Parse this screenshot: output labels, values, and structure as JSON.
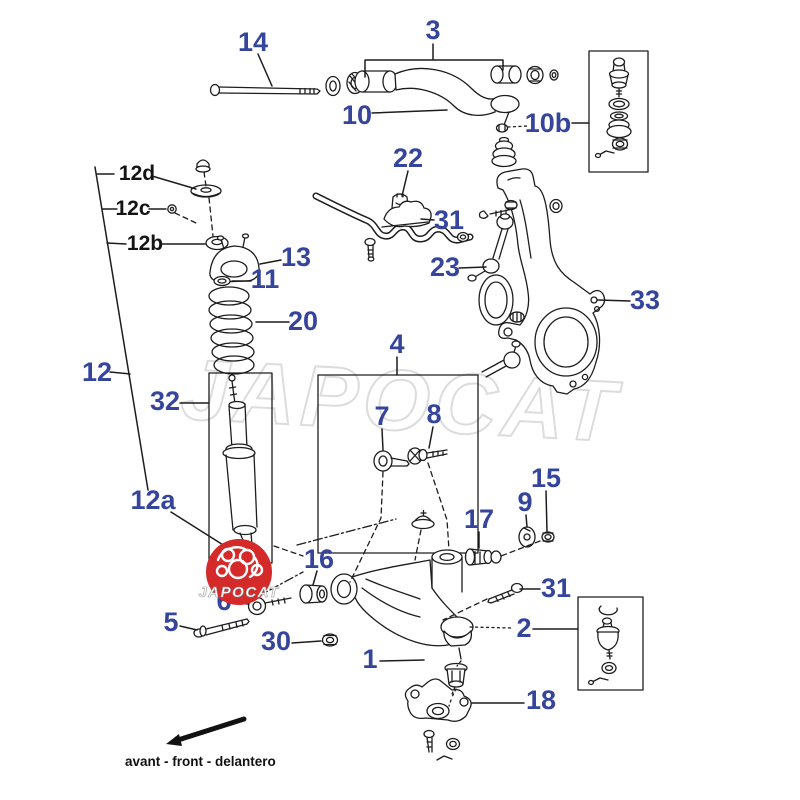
{
  "diagram": {
    "watermark_text": "JAPOCAT",
    "logo": {
      "text": "JAPOCAT",
      "bg_color": "#d42a2a"
    },
    "direction_label": "avant - front - delantero",
    "colors": {
      "label_blue": "#36459c",
      "label_black": "#141414",
      "line": "#1d1d1d",
      "logo_red": "#d42a2a",
      "watermark_gray": "#dcdcdc"
    },
    "labels": [
      {
        "id": "14",
        "text": "14"
      },
      {
        "id": "3",
        "text": "3"
      },
      {
        "id": "10",
        "text": "10"
      },
      {
        "id": "10b",
        "text": "10b"
      },
      {
        "id": "22",
        "text": "22"
      },
      {
        "id": "12d",
        "text": "12d"
      },
      {
        "id": "12c",
        "text": "12c"
      },
      {
        "id": "12b",
        "text": "12b"
      },
      {
        "id": "13",
        "text": "13"
      },
      {
        "id": "11",
        "text": "11"
      },
      {
        "id": "20",
        "text": "20"
      },
      {
        "id": "31-bracket",
        "text": "31"
      },
      {
        "id": "23",
        "text": "23"
      },
      {
        "id": "33",
        "text": "33"
      },
      {
        "id": "12",
        "text": "12"
      },
      {
        "id": "32",
        "text": "32"
      },
      {
        "id": "12a",
        "text": "12a"
      },
      {
        "id": "4",
        "text": "4"
      },
      {
        "id": "7",
        "text": "7"
      },
      {
        "id": "8",
        "text": "8"
      },
      {
        "id": "15",
        "text": "15"
      },
      {
        "id": "9",
        "text": "9"
      },
      {
        "id": "17",
        "text": "17"
      },
      {
        "id": "16",
        "text": "16"
      },
      {
        "id": "6",
        "text": "6"
      },
      {
        "id": "5",
        "text": "5"
      },
      {
        "id": "30",
        "text": "30"
      },
      {
        "id": "1",
        "text": "1"
      },
      {
        "id": "31-bolt",
        "text": "31"
      },
      {
        "id": "2",
        "text": "2"
      },
      {
        "id": "18",
        "text": "18"
      }
    ]
  }
}
